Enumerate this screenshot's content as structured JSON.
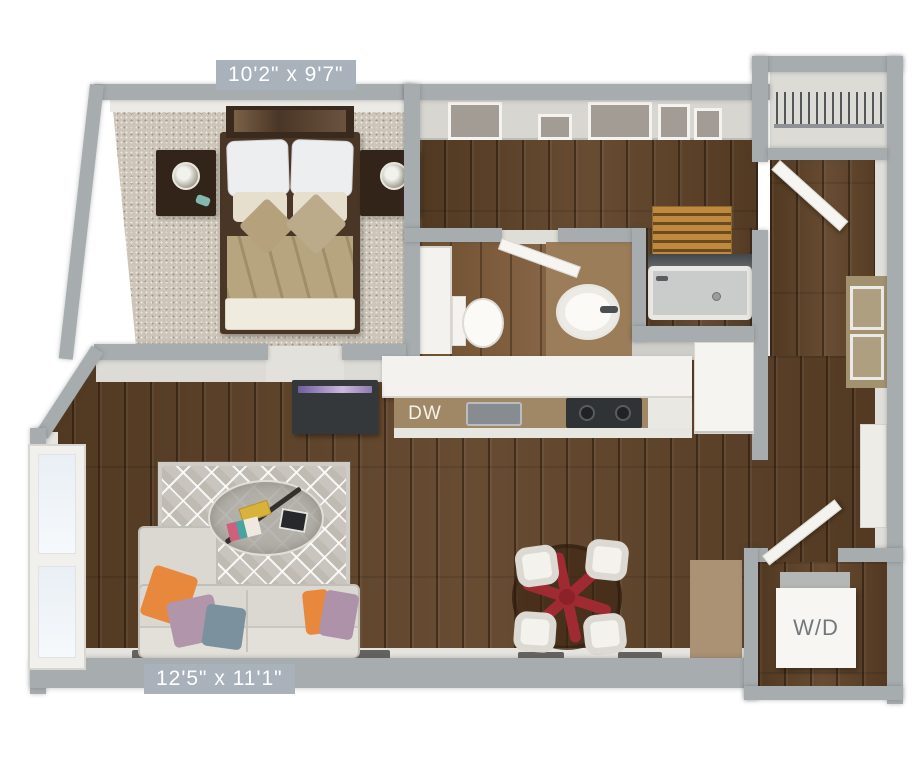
{
  "view": {
    "type": "3d-floorplan-top-view",
    "background": "#ffffff"
  },
  "labels": {
    "bedroom_dimensions": "10'2\" x 9'7\"",
    "living_room_dimensions": "12'5\" x 11'1\"",
    "dishwasher": "DW",
    "washer_dryer": "W/D"
  },
  "colors": {
    "wall_gray": "#a7acaf",
    "wall_face_white": "#e6e4df",
    "hardwood_dark": "#5e4126",
    "hardwood_bathroom": "#7b5836",
    "carpet_beige": "#cdc5b8",
    "rug_gray": "#c9c5be",
    "dimension_badge": "#a9b2bb",
    "dimension_text": "#ffffff",
    "counter_tan": "#a08866",
    "countertop_white": "#f3f2ee",
    "sofa_gray": "#dbd8d2",
    "pillow_orange": "#e8883d",
    "pillow_lavender": "#b095ab",
    "pillow_slate": "#7b919e",
    "dining_base_red": "#a02a31",
    "bed_duvet_tan": "#b6a57e",
    "wd_label_text": "#71787e",
    "pantry_slat_orange": "#c08a3e"
  },
  "rooms": [
    {
      "name": "bedroom",
      "floor": "carpet",
      "dimensions": "10'2\" x 9'7\"",
      "furniture": [
        "bed",
        "headboard-shelf",
        "nightstand-left",
        "nightstand-right",
        "table-lamps"
      ]
    },
    {
      "name": "entry-hall",
      "floor": "hardwood",
      "furniture": [
        "upper-cabinets",
        "pantry-shelves",
        "coat-closet",
        "entry-door-open"
      ]
    },
    {
      "name": "bathroom",
      "floor": "hardwood",
      "furniture": [
        "linen-cabinet",
        "toilet",
        "vanity-sink",
        "bathtub"
      ]
    },
    {
      "name": "kitchen",
      "floor": "hardwood",
      "furniture": [
        "bar-counter",
        "kitchen-sink",
        "cooktop",
        "dishwasher",
        "refrigerator"
      ]
    },
    {
      "name": "living-room",
      "floor": "hardwood",
      "dimensions": "12'5\" x 11'1\"",
      "furniture": [
        "sectional-sofa",
        "throw-pillows",
        "area-rug",
        "coffee-table",
        "tv-console",
        "window"
      ]
    },
    {
      "name": "dining-area",
      "floor": "hardwood",
      "furniture": [
        "round-glass-table",
        "red-star-base",
        "four-chairs"
      ]
    },
    {
      "name": "laundry-closet",
      "floor": "hardwood",
      "furniture": [
        "washer-dryer",
        "closet-door-open"
      ]
    }
  ]
}
